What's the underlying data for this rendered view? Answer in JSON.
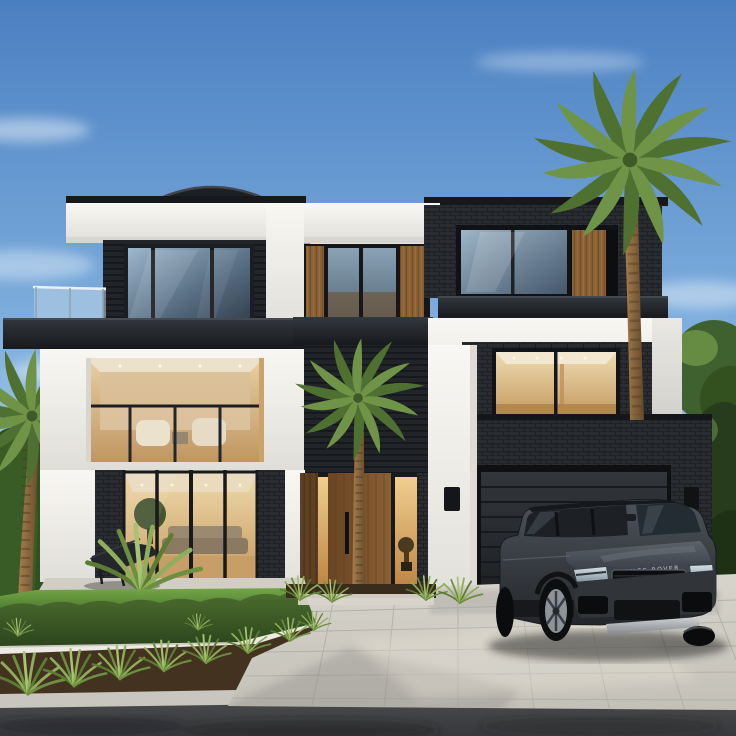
{
  "scene": {
    "description": "Photorealistic exterior render of a modern three-level home with charcoal brick, black cladding and white stucco volumes, a curved dark roof dome, glass balcony railings, warm-lit interiors, a timber entry door with lit sidelights, a double garage, a dark grey luxury SUV parked on a light stone-tile driveway, palm trees and manicured landscaping under a clear blue daytime sky.",
    "time_of_day": "day",
    "objects": [
      "sky",
      "wispy clouds",
      "modern house",
      "roof dome",
      "glass balcony railing",
      "upper floor windows",
      "living room interior with sofas",
      "lounge chairs",
      "timber front door",
      "lit sidelights",
      "garage sectional door",
      "wall lights",
      "white pillar",
      "dark grey SUV",
      "stone tile driveway",
      "green lawn",
      "boxwood hedge",
      "white planter wall",
      "ornamental grasses",
      "mulch garden bed",
      "palm tree left",
      "palm tree center",
      "palm tree right",
      "neighbouring roof",
      "sidewalk",
      "asphalt road",
      "background trees"
    ]
  },
  "suv": {
    "badge": "RANGE ROVER"
  },
  "counts": {
    "palm_trees": 3,
    "vehicles": 1,
    "garage_doors": 1
  },
  "palette": {
    "sky_top": "#4a7fc1",
    "sky_mid": "#7fafde",
    "sky_horizon": "#bdd8ee",
    "cloud": "#ffffff",
    "stucco_white": "#f8f7f3",
    "stucco_shade": "#e0ded8",
    "brick_dark": "#292c30",
    "cladding_dark": "#212429",
    "fascia_dark": "#17191c",
    "wood_door": "#8a6035",
    "interior_glow": "#f0cf8e",
    "interior_warm": "#c79a5e",
    "glass_sky": "#9db7cc",
    "glass_dark": "#45586b",
    "lawn_light": "#74a648",
    "lawn_dark": "#4f7c30",
    "hedge_light": "#4d7030",
    "hedge_dark": "#2b431c",
    "grass_blade": "#8fae5b",
    "palm_frond": "#6f9447",
    "palm_frond_dark": "#4e7030",
    "palm_trunk": "#a8804f",
    "tree_green": "#4c6f33",
    "mulch": "#43321f",
    "driveway": "#d7d4cb",
    "sidewalk": "#c8c6bf",
    "planter_white": "#eceae4",
    "road": "#4a4b4d",
    "suv_body_light": "#4d535a",
    "suv_body_dark": "#23262a",
    "suv_glass": "#1d2126",
    "suv_trim": "#d0d2d4"
  }
}
